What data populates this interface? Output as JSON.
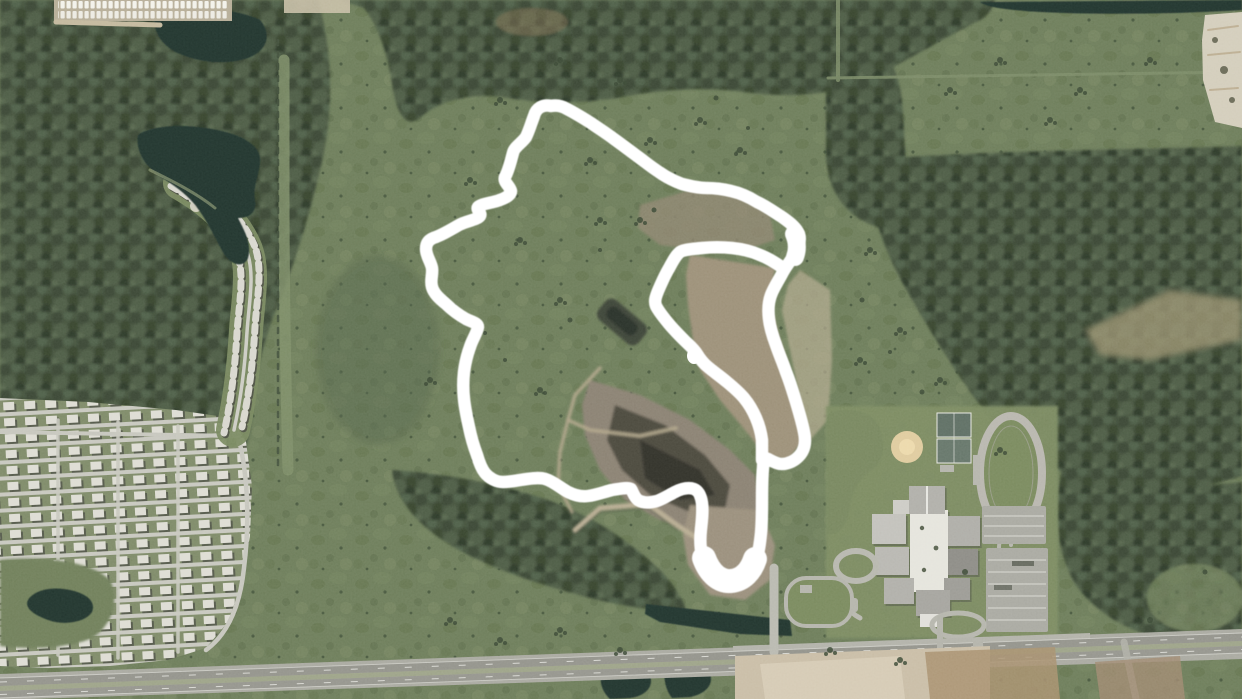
{
  "map": {
    "view": "aerial-satellite-imagery",
    "description": "Aerial photo of a semi-rural parcel: dense forest, a lakeside subdivision and storage yard on the west, a cleared/excavated tract in the center circled by a hand-drawn white outline, a school campus with track, courts and ball field to the southeast, and a divided highway across the bottom.",
    "annotation": {
      "color": "#ffffff",
      "stroke_width": 12.5,
      "outer_path": "M551,106 C543,104 536,108 534,116 C531,124 529,131 526,137 C522,143 514,147 513,153 C511,160 509,170 505,177 C503,182 510,186 511,191 C511,196 503,199 497,201 C490,203 481,204 478,207 C476,210 482,213 480,216 C477,220 466,221 459,225 C452,229 444,234 436,237 C429,239 426,243 426,249 C426,256 431,262 432,268 C433,275 430,280 432,287 C434,294 440,299 446,304 C452,310 459,315 466,319 C472,322 478,323 478,327 C477,333 472,340 470,347 C467,355 465,364 464,372 C463,381 463,390 464,399 C465,409 467,418 469,427 C471,437 474,447 477,455 C479,462 481,468 485,473 C489,478 496,482 503,482 C511,482 519,480 527,479 C534,478 542,477 548,480 C555,483 561,488 568,492 C574,495 581,497 588,496 C596,495 604,492 612,490 C619,489 627,487 631,489 C633,492 634,497 638,500 C643,503 650,503 657,501 C663,499 669,495 675,492 C681,489 688,487 694,489 C699,491 701,496 702,503 C703,511 702,520 701,529 C700,538 700,547 702,555 C704,563 709,570 716,574 C723,578 732,580 740,577 C747,574 753,568 756,560 C759,552 760,543 761,533 C762,522 762,511 762,500 C762,489 762,478 763,468 C763,462 764,457 768,459 C772,461 777,464 782,464 C788,464 795,461 800,455 C805,449 806,441 804,432 C802,422 799,412 796,402 C793,392 790,382 786,372 C783,363 779,354 776,345 C773,337 770,328 769,319 C768,311 768,303 771,295 C774,287 779,280 783,272 C787,265 792,259 796,252 C799,246 801,240 799,234 C796,227 789,222 782,217 C774,212 766,206 757,202 C749,197 740,193 731,191 C723,189 714,188 706,188 C698,188 690,186 682,184 C674,181 666,177 659,172 C651,167 644,161 637,156 C629,150 621,144 614,139 C606,133 598,128 591,123 C583,118 575,113 567,109 C562,106 556,105 551,106 Z",
      "inner_path": "M783,268 C776,263 768,258 760,255 C751,251 742,249 732,248 C722,247 712,247 702,248 C694,249 685,249 680,252 C675,256 672,263 668,270 C664,277 661,284 658,291 C656,296 654,301 656,306 C659,312 664,318 669,324 C674,330 680,336 685,341 C689,345 694,349 697,354 C700,359 703,363 708,367 C714,372 721,377 727,382 C733,387 739,392 744,398 C749,404 753,411 756,418 C759,425 761,432 762,440 C762,447 762,454 762,460",
      "bottom_blob_path": "M704,558 C710,574 720,582 731,581 C743,580 751,571 755,559",
      "junction_blob_path": "M794,234 C797,241 798,249 795,257",
      "hook_dot_path": "M687,356 C687,351 690,348 694,348 C699,348 702,352 702,357 C702,361 698,364 694,364 C690,364 687,360 687,356 Z"
    },
    "palette": {
      "forest": "#45523e",
      "field": "#6d7d5a",
      "water": "#22352f",
      "dirt_light": "#a39884",
      "dirt_dark": "#4c483e",
      "road_base": "#a9a9a0",
      "roof_light": "#dddcd3",
      "annotation": "#ffffff"
    },
    "features": [
      "storage-yard-parking-lot",
      "retention-ponds",
      "lake-with-homes",
      "residential-subdivision",
      "forest-tracts",
      "scrub-fields",
      "excavated-clearing-with-spoil-piles",
      "white-outline-annotation",
      "school-campus",
      "running-track",
      "tennis-courts",
      "baseball-diamond",
      "divided-highway",
      "drainage-canals",
      "dirt-access-roads"
    ]
  }
}
